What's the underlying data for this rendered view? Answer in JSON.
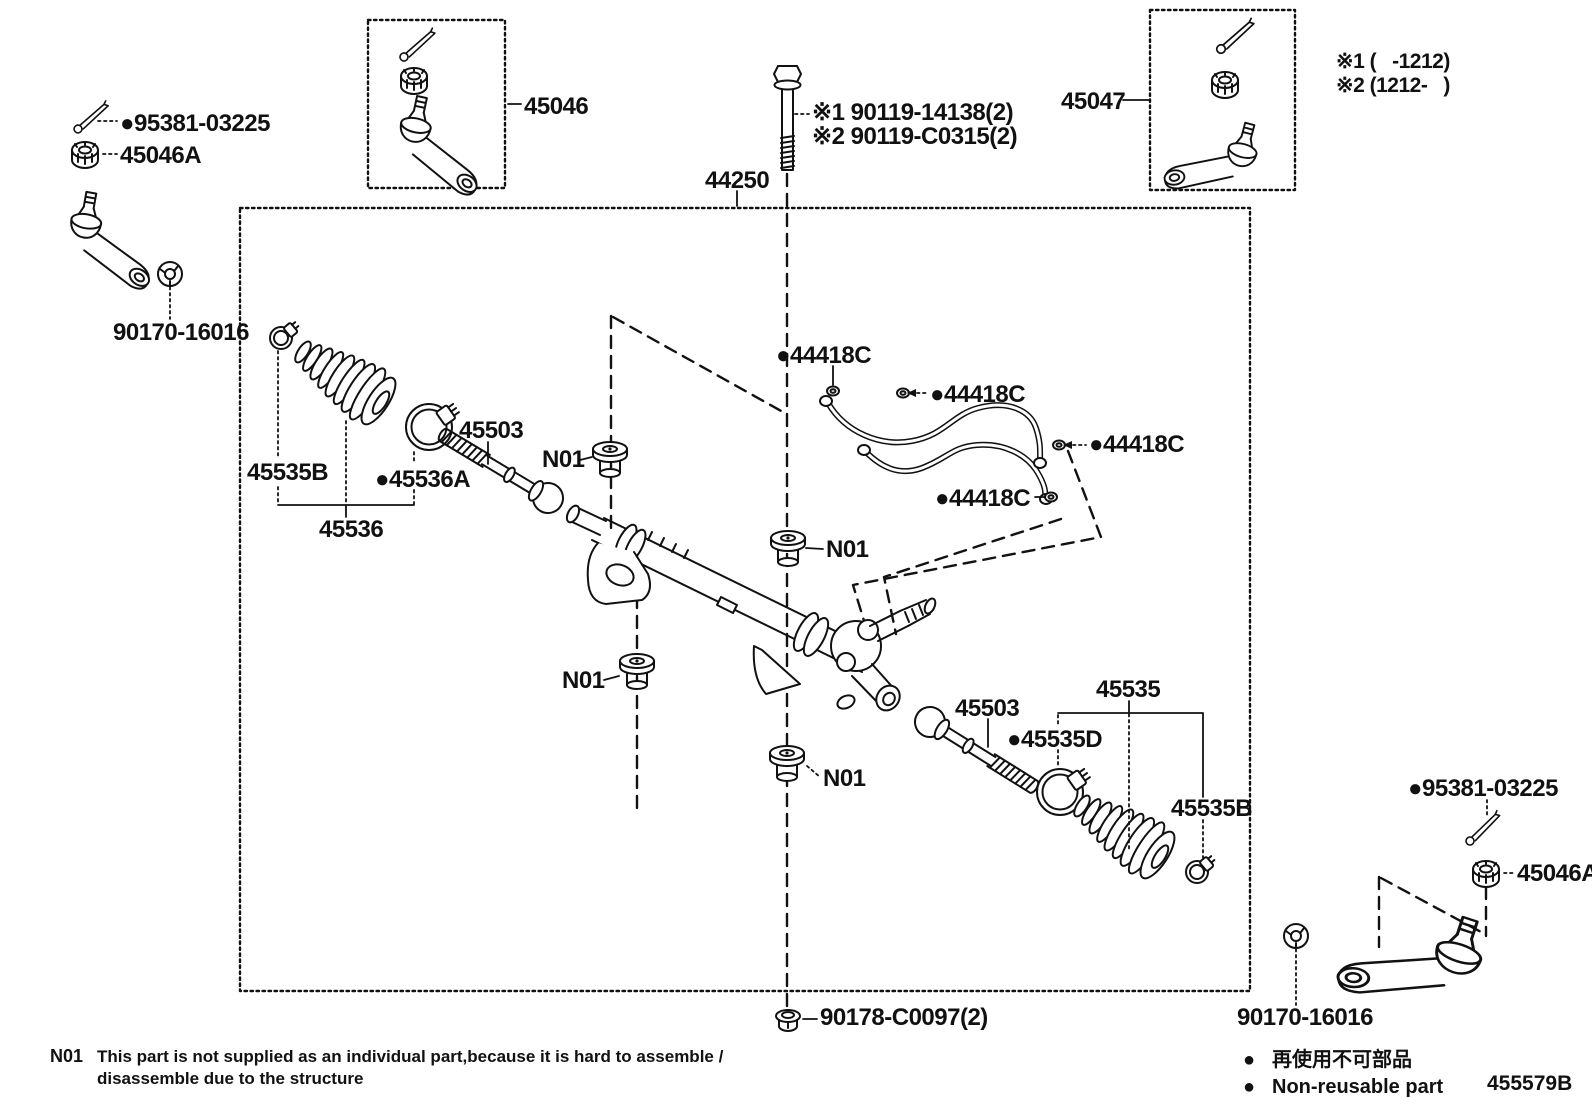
{
  "colors": {
    "ink": "#111111",
    "bg": "#ffffff"
  },
  "callouts": {
    "p95381": "●95381-03225",
    "p45046A": "45046A",
    "p90170": "90170-16016",
    "p45046": "45046",
    "p45047": "45047",
    "p44250": "44250",
    "p90119_1": "※1 90119-14138(2)",
    "p90119_2": "※2 90119-C0315(2)",
    "note1": "※1 (   -1212)",
    "note2": "※2 (1212-   )",
    "p44418C": "●44418C",
    "p45503": "45503",
    "n01": "N01",
    "p45535B": "45535B",
    "p45536A": "●45536A",
    "p45536": "45536",
    "p45535": "45535",
    "p45535D": "●45535D",
    "p90178": "90178-C0097(2)"
  },
  "footnote": {
    "code": "N01",
    "line1": "This part is not supplied as an individual part,because it is hard to assemble /",
    "line2": "disassemble due to the structure"
  },
  "legend": {
    "bullet": "●",
    "jp": "再使用不可部品",
    "en": "Non-reusable part"
  },
  "sheet_code": "455579B"
}
